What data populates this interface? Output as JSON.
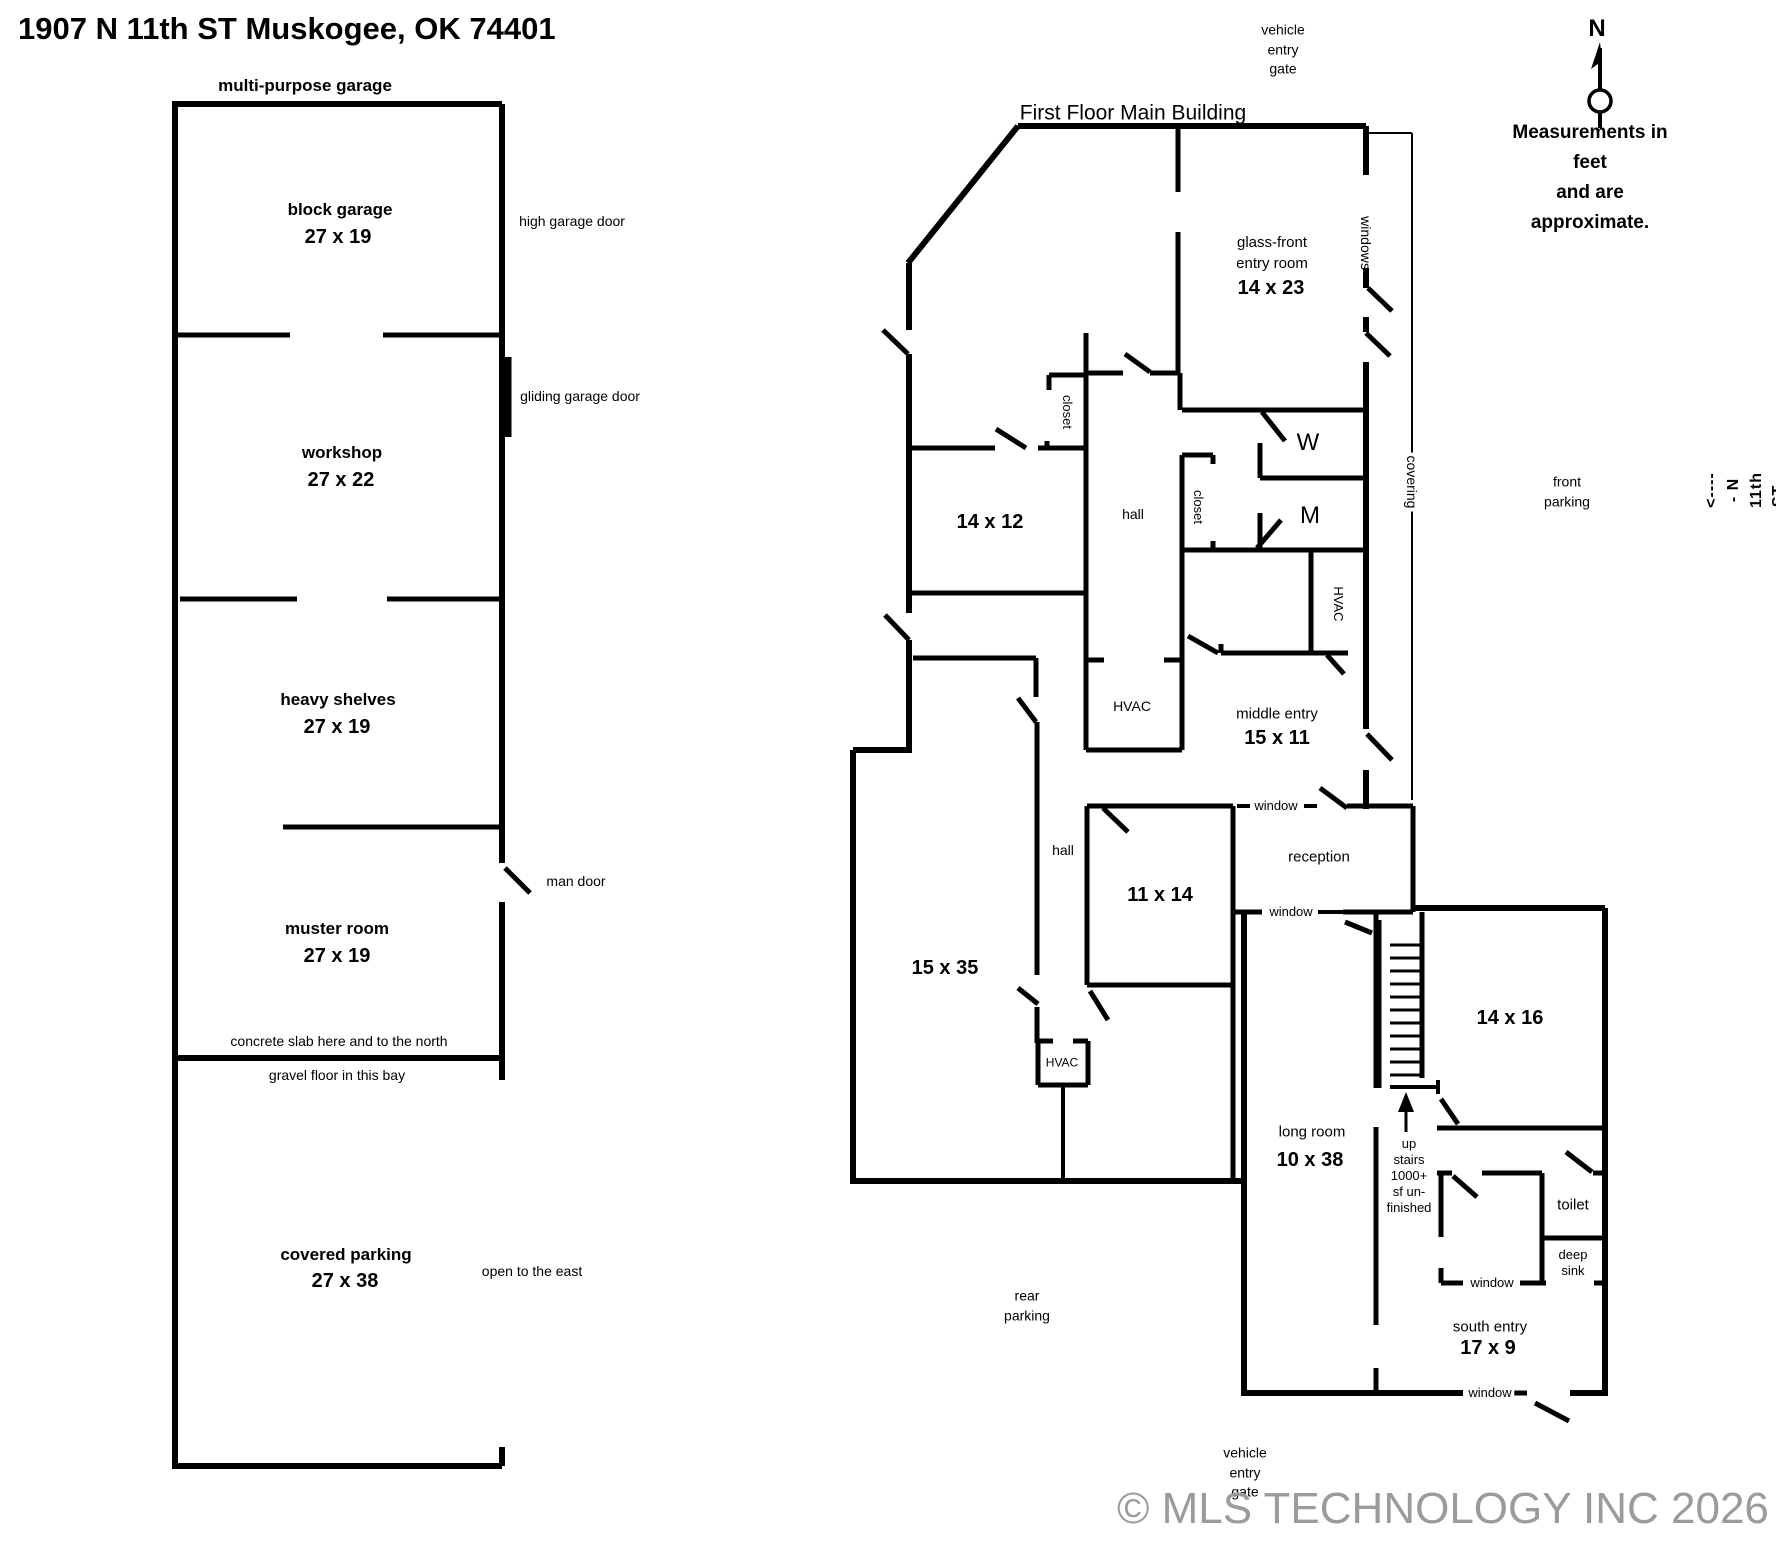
{
  "colors": {
    "background": "#ffffff",
    "walls": "#000000",
    "text": "#000000",
    "watermark": "#9b9b9b"
  },
  "labels": [
    {
      "name": "address-title",
      "text": "1907 N 11th ST  Muskogee, OK  74401",
      "x": 18,
      "y": 7,
      "cls": "t1 noc"
    },
    {
      "name": "garage-title",
      "text": "multi-purpose garage",
      "x": 305,
      "y": 86,
      "cls": "gt"
    },
    {
      "name": "block-garage-name",
      "text": "block garage",
      "x": 340,
      "y": 210,
      "cls": "gt"
    },
    {
      "name": "block-garage-dim",
      "text": "27 x 19",
      "x": 338,
      "y": 237,
      "cls": "dim"
    },
    {
      "name": "high-garage-door",
      "text": "high garage door",
      "x": 572,
      "y": 222,
      "cls": "ann"
    },
    {
      "name": "gliding-garage-door",
      "text": "gliding garage door",
      "x": 580,
      "y": 397,
      "cls": "ann"
    },
    {
      "name": "workshop-name",
      "text": "workshop",
      "x": 342,
      "y": 453,
      "cls": "gt"
    },
    {
      "name": "workshop-dim",
      "text": "27 x 22",
      "x": 341,
      "y": 480,
      "cls": "dim"
    },
    {
      "name": "heavy-shelves-name",
      "text": "heavy shelves",
      "x": 338,
      "y": 700,
      "cls": "gt"
    },
    {
      "name": "heavy-shelves-dim",
      "text": "27 x 19",
      "x": 337,
      "y": 727,
      "cls": "dim"
    },
    {
      "name": "man-door",
      "text": "man door",
      "x": 576,
      "y": 882,
      "cls": "ann"
    },
    {
      "name": "muster-room-name",
      "text": "muster room",
      "x": 337,
      "y": 929,
      "cls": "gt"
    },
    {
      "name": "muster-room-dim",
      "text": "27 x 19",
      "x": 337,
      "y": 956,
      "cls": "dim"
    },
    {
      "name": "concrete-slab-note",
      "text": "concrete slab here and to the north",
      "x": 339,
      "y": 1042,
      "cls": "ann"
    },
    {
      "name": "gravel-floor-note",
      "text": "gravel floor in this bay",
      "x": 337,
      "y": 1076,
      "cls": "ann"
    },
    {
      "name": "covered-parking-name",
      "text": "covered parking",
      "x": 346,
      "y": 1255,
      "cls": "gt"
    },
    {
      "name": "covered-parking-dim",
      "text": "27 x 38",
      "x": 345,
      "y": 1281,
      "cls": "dim"
    },
    {
      "name": "open-east-note",
      "text": "open to the east",
      "x": 532,
      "y": 1272,
      "cls": "ann"
    },
    {
      "name": "main-title",
      "text": "First Floor Main Building",
      "x": 1133,
      "y": 113,
      "cls": "t2"
    },
    {
      "name": "vehicle-gate-top",
      "text": "vehicle\nentry\ngate",
      "x": 1283,
      "y": 50,
      "cls": "ann"
    },
    {
      "name": "glass-front-name",
      "text": "glass-front\nentry room",
      "x": 1272,
      "y": 253,
      "cls": "rn"
    },
    {
      "name": "glass-front-dim",
      "text": "14 x 23",
      "x": 1271,
      "y": 288,
      "cls": "dim"
    },
    {
      "name": "windows-label",
      "text": "windows",
      "x": 1365,
      "y": 243,
      "cls": "ann v90"
    },
    {
      "name": "covering-label",
      "text": "covering",
      "x": 1411,
      "y": 482,
      "cls": "ann v90 bgw"
    },
    {
      "name": "closet-1-label",
      "text": "closet",
      "x": 1067,
      "y": 412,
      "cls": "sm v90"
    },
    {
      "name": "closet-2-label",
      "text": "closet",
      "x": 1198,
      "y": 507,
      "cls": "sm v90"
    },
    {
      "name": "hall-upper-label",
      "text": "hall",
      "x": 1133,
      "y": 515,
      "cls": "ann"
    },
    {
      "name": "womens-room-label",
      "text": "W",
      "x": 1308,
      "y": 443,
      "cls": "big"
    },
    {
      "name": "mens-room-label",
      "text": "M",
      "x": 1310,
      "y": 516,
      "cls": "big"
    },
    {
      "name": "hvac-closet-label",
      "text": "HVAC",
      "x": 1338,
      "y": 604,
      "cls": "sm v90"
    },
    {
      "name": "room-14x12-dim",
      "text": "14 x 12",
      "x": 990,
      "y": 522,
      "cls": "dim"
    },
    {
      "name": "hvac-1-label",
      "text": "HVAC",
      "x": 1132,
      "y": 707,
      "cls": "ann"
    },
    {
      "name": "middle-entry-name",
      "text": "middle entry",
      "x": 1277,
      "y": 714,
      "cls": "rn"
    },
    {
      "name": "middle-entry-dim",
      "text": "15 x 11",
      "x": 1277,
      "y": 738,
      "cls": "dim"
    },
    {
      "name": "front-parking-label",
      "text": "front\nparking",
      "x": 1567,
      "y": 492,
      "cls": "ann"
    },
    {
      "name": "measurements-note",
      "text": "Measurements in feet\nand are approximate.",
      "x": 1590,
      "y": 178,
      "cls": "note"
    },
    {
      "name": "north-label",
      "text": "N",
      "x": 1597,
      "y": 29,
      "cls": "north"
    },
    {
      "name": "street-label",
      "text": "<----- N 11th ST ----->",
      "x": 1757,
      "y": 490,
      "cls": "street v-90"
    },
    {
      "name": "window-label-1",
      "text": "window",
      "x": 1276,
      "y": 806,
      "cls": "sm bgw"
    },
    {
      "name": "window-label-2",
      "text": "window",
      "x": 1291,
      "y": 912,
      "cls": "sm bgw"
    },
    {
      "name": "reception-label",
      "text": "reception",
      "x": 1319,
      "y": 857,
      "cls": "rn"
    },
    {
      "name": "room-11x14-dim",
      "text": "11 x 14",
      "x": 1160,
      "y": 895,
      "cls": "dim"
    },
    {
      "name": "room-15x35-dim",
      "text": "15 x 35",
      "x": 945,
      "y": 968,
      "cls": "dim"
    },
    {
      "name": "hall-lower-label",
      "text": "hall",
      "x": 1063,
      "y": 851,
      "cls": "ann"
    },
    {
      "name": "hvac-2-label",
      "text": "HVAC",
      "x": 1062,
      "y": 1063,
      "cls": "xs"
    },
    {
      "name": "rear-parking-label",
      "text": "rear\nparking",
      "x": 1027,
      "y": 1306,
      "cls": "ann"
    },
    {
      "name": "room-14x16-dim",
      "text": "14 x 16",
      "x": 1510,
      "y": 1018,
      "cls": "dim"
    },
    {
      "name": "upstairs-note",
      "text": "up\nstairs\n1000+\nsf un-\nfinished",
      "x": 1409,
      "y": 1176,
      "cls": "sm tight"
    },
    {
      "name": "long-room-name",
      "text": "long room",
      "x": 1312,
      "y": 1132,
      "cls": "rn"
    },
    {
      "name": "long-room-dim",
      "text": "10 x 38",
      "x": 1310,
      "y": 1160,
      "cls": "dim"
    },
    {
      "name": "toilet-label",
      "text": "toilet",
      "x": 1573,
      "y": 1205,
      "cls": "rn"
    },
    {
      "name": "deep-sink-label",
      "text": "deep\nsink",
      "x": 1573,
      "y": 1263,
      "cls": "sm tight"
    },
    {
      "name": "window-label-3",
      "text": "window",
      "x": 1492,
      "y": 1283,
      "cls": "sm bgw"
    },
    {
      "name": "window-label-4",
      "text": "window",
      "x": 1490,
      "y": 1393,
      "cls": "sm bgw"
    },
    {
      "name": "south-entry-name",
      "text": "south entry",
      "x": 1490,
      "y": 1327,
      "cls": "rn"
    },
    {
      "name": "south-entry-dim",
      "text": "17 x 9",
      "x": 1488,
      "y": 1348,
      "cls": "dim"
    },
    {
      "name": "vehicle-gate-bottom",
      "text": "vehicle\nentry\ngate",
      "x": 1245,
      "y": 1473,
      "cls": "ann"
    },
    {
      "name": "watermark",
      "text": "© MLS TECHNOLOGY INC 2026",
      "x": 1117,
      "y": 1478,
      "cls": "wm noc"
    }
  ]
}
